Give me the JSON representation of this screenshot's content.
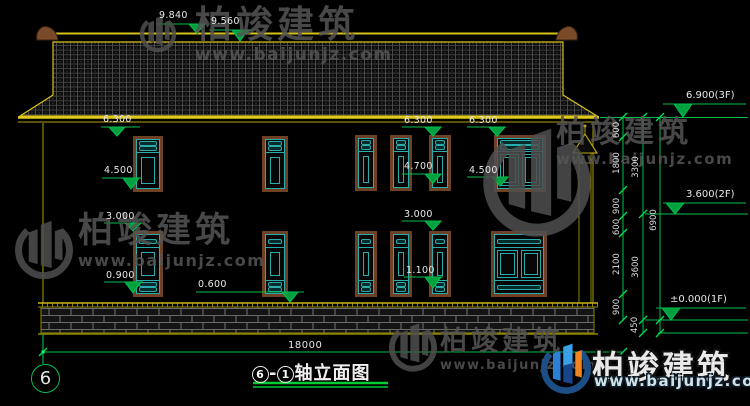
{
  "drawing": {
    "title": {
      "axis_from": "6",
      "separator": "-",
      "axis_to": "1",
      "name": "轴立面图"
    },
    "axis_bubble": "6",
    "total_width_dim": "18000",
    "facade_levels": [
      "9.840",
      "9.560",
      "6.300",
      "6.300",
      "6.300",
      "4.500",
      "4.700",
      "4.500",
      "3.000",
      "3.000",
      "0.900",
      "1.100",
      "0.600"
    ],
    "floor_levels": [
      "6.900(3F)",
      "3.600(2F)",
      "±0.000(1F)"
    ],
    "chain_dims": [
      "600",
      "1800",
      "900",
      "600",
      "2100",
      "900",
      "3300",
      "3600",
      "450",
      "6900"
    ]
  },
  "watermark": {
    "brand": "柏竣建筑",
    "url": "www.baijunjz.com"
  },
  "colors": {
    "line_yellow": "#d8c21a",
    "line_olive": "#8f8500",
    "dim_green": "#00c04b",
    "window_cyan": "#2aacac",
    "window_brown": "#6e4124",
    "text_white": "#e8e8e8",
    "watermark_gray": "#555555",
    "logo_blue": "#2b7fd4",
    "logo_navy": "#1d4f86",
    "logo_orange": "#f08423"
  }
}
